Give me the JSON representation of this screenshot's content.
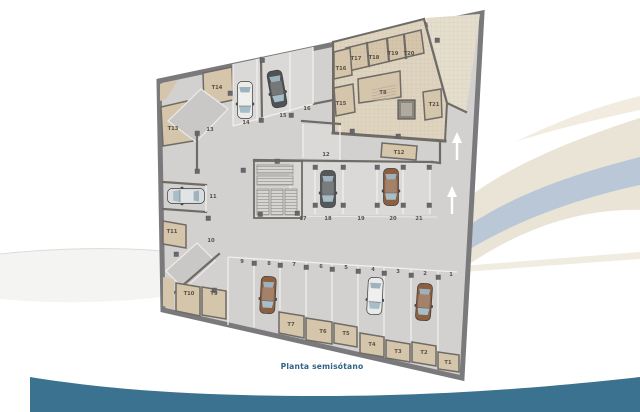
{
  "caption": "Planta semisótano",
  "colors": {
    "accent_teal": "#3b7290",
    "band_blue": "#b9c7d6",
    "band_cream": "#eae4d6",
    "walls": "#7a7a7c",
    "floor": "#d2d1cf",
    "storage_tan": "#d5c5aa"
  },
  "parking": [
    "1",
    "2",
    "3",
    "4",
    "5",
    "6",
    "7",
    "8",
    "9",
    "10",
    "11",
    "12",
    "13",
    "14",
    "15",
    "16",
    "17",
    "18",
    "19",
    "20",
    "21"
  ],
  "storage": [
    "T1",
    "T2",
    "T3",
    "T4",
    "T5",
    "T6",
    "T7",
    "T8",
    "T9",
    "T10",
    "T11",
    "T12",
    "T13",
    "T14",
    "T15",
    "T16",
    "T17",
    "T18",
    "T19",
    "T20",
    "T21"
  ],
  "cars": [
    {
      "spot": "14",
      "color": "#ebebe9"
    },
    {
      "spot": "15",
      "color": "#4e5254"
    },
    {
      "spot": "11",
      "color": "#d9dddf"
    },
    {
      "spot": "18",
      "color": "#54585a"
    },
    {
      "spot": "20",
      "color": "#8b5f40"
    },
    {
      "spot": "8",
      "color": "#8b5f40"
    },
    {
      "spot": "4",
      "color": "#e9ebea"
    },
    {
      "spot": "2",
      "color": "#8b5f40"
    }
  ],
  "arrows": [
    {
      "direction": "up"
    },
    {
      "direction": "up"
    }
  ]
}
